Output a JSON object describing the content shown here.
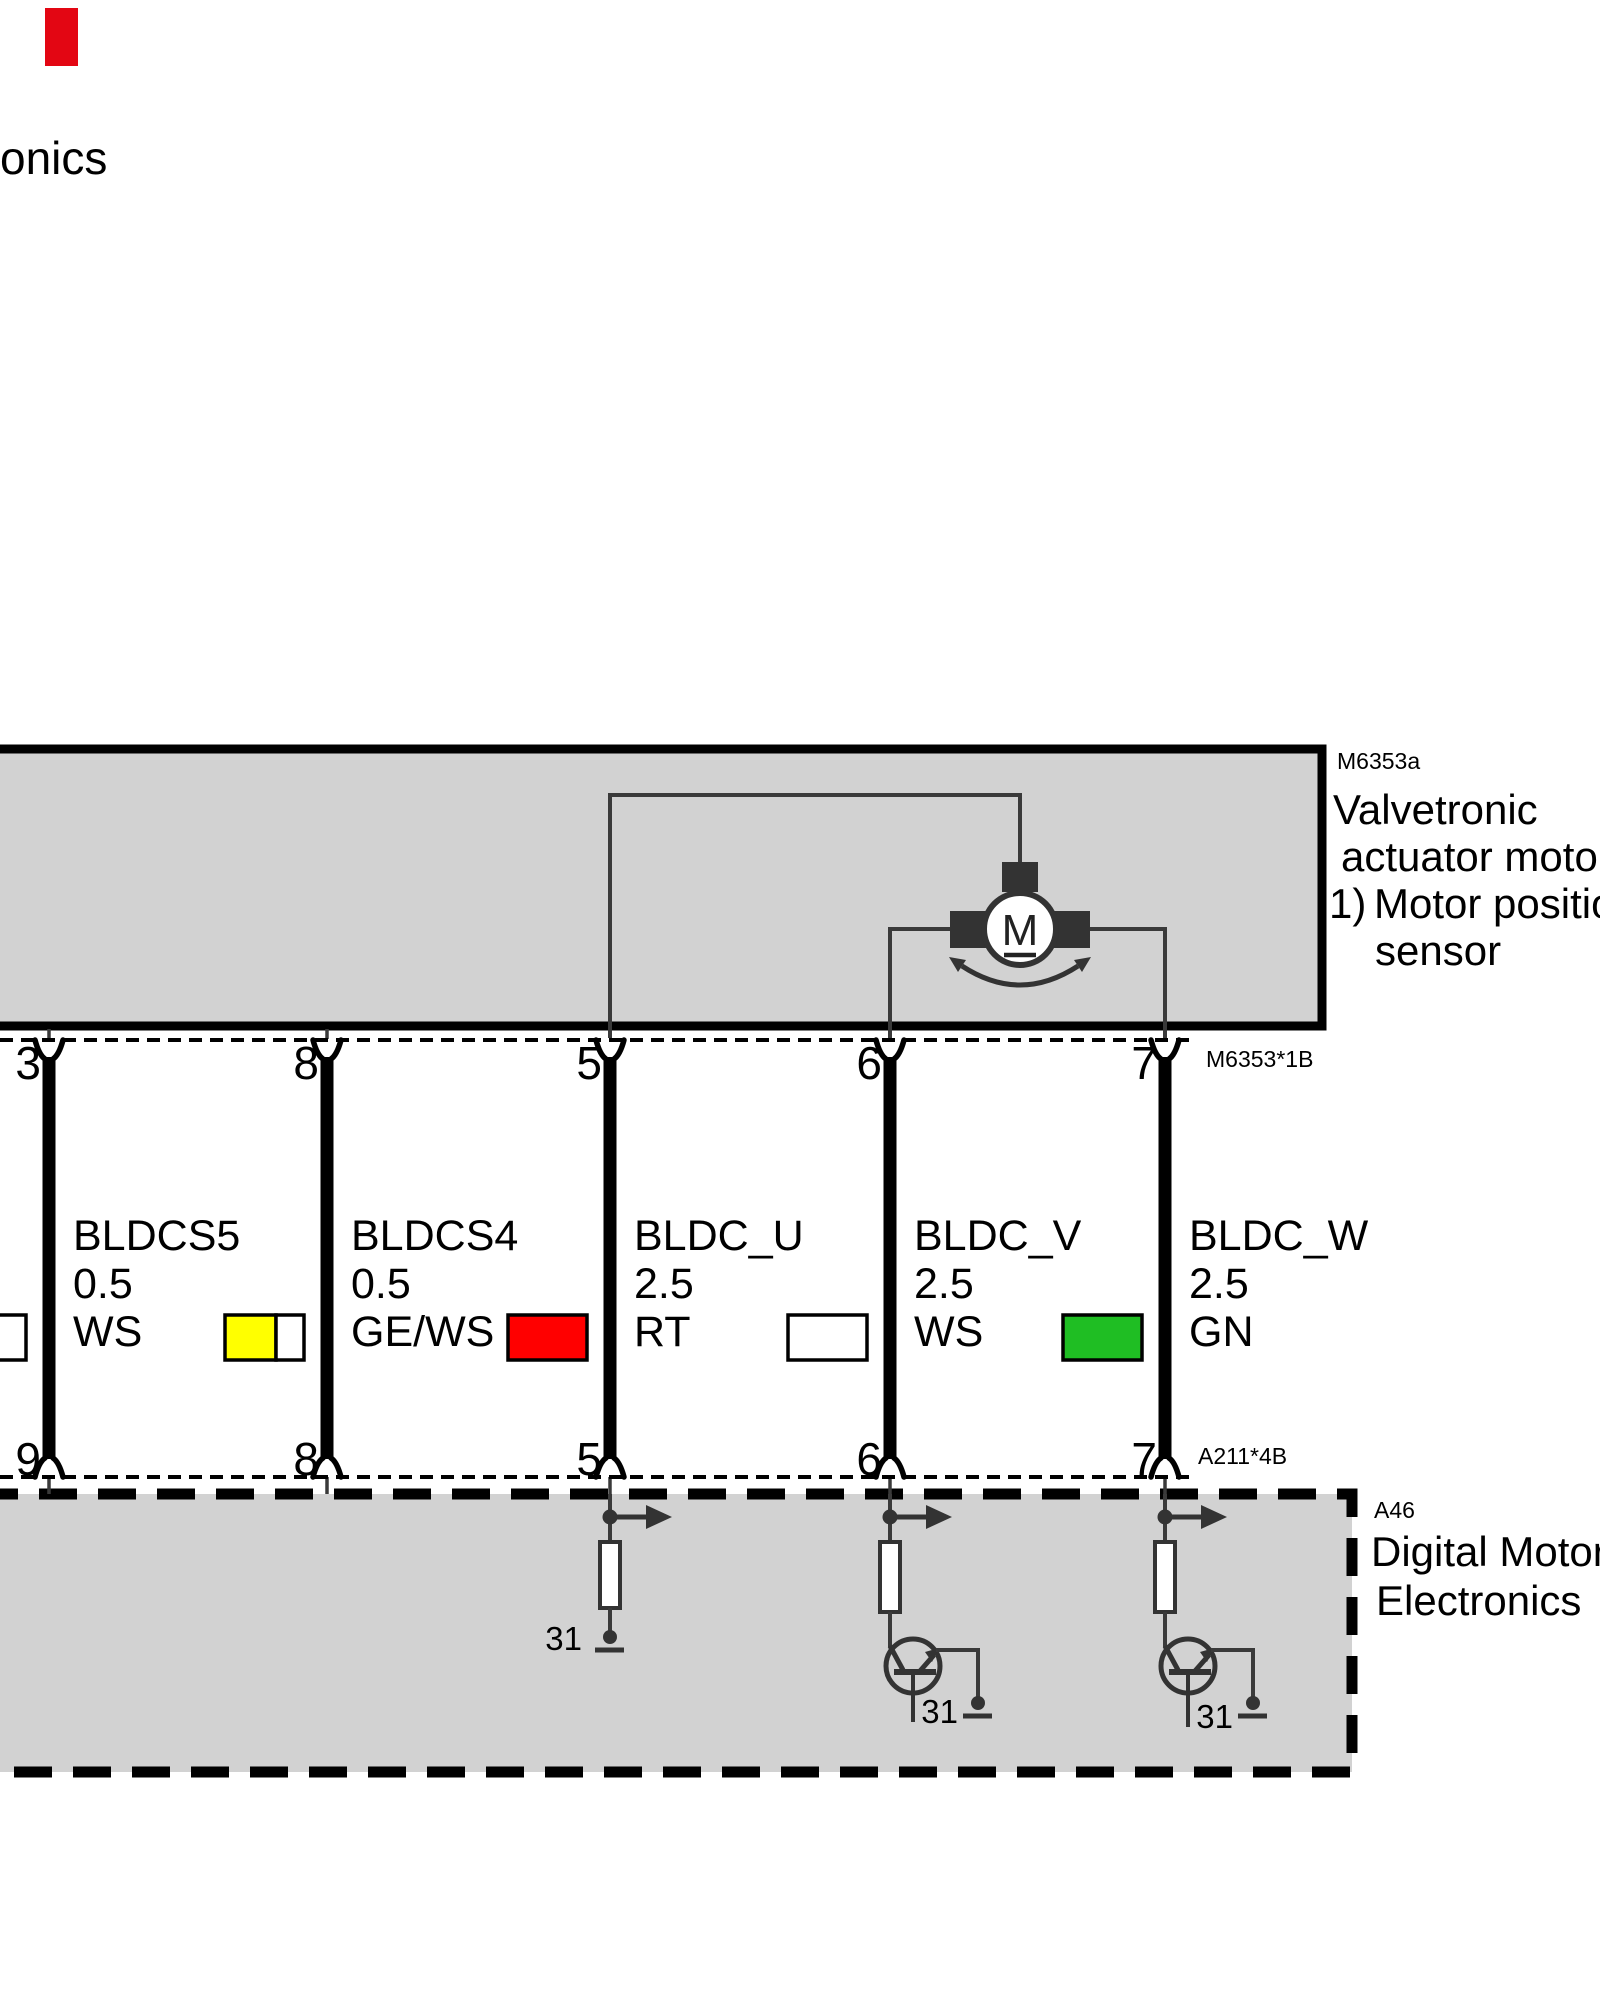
{
  "page": {
    "header_fragment": "onics",
    "marker_color": "#e30613"
  },
  "top_box": {
    "ref": "M6353a",
    "title_line1": "Valvetronic",
    "title_line2": "actuator motor",
    "note_number": "1)",
    "note_line1": "Motor position",
    "note_line2": "sensor",
    "fill": "#d2d2d2",
    "motor_letter": "M"
  },
  "connectors": {
    "top": {
      "ref": "M6353*1B",
      "pins": [
        "3",
        "8",
        "5",
        "6",
        "7"
      ]
    },
    "bottom": {
      "ref": "A211*4B",
      "pins": [
        "9",
        "8",
        "5",
        "6",
        "7"
      ]
    }
  },
  "wires": [
    {
      "name": "BLDCS5",
      "size": "0.5",
      "color_code": "WS",
      "swatch": [
        "#ffffff"
      ]
    },
    {
      "name": "BLDCS4",
      "size": "0.5",
      "color_code": "GE/WS",
      "swatch": [
        "#ffff00",
        "#ffffff"
      ]
    },
    {
      "name": "BLDC_U",
      "size": "2.5",
      "color_code": "RT",
      "swatch": [
        "#ff0000"
      ]
    },
    {
      "name": "BLDC_V",
      "size": "2.5",
      "color_code": "WS",
      "swatch": [
        "#ffffff"
      ]
    },
    {
      "name": "BLDC_W",
      "size": "2.5",
      "color_code": "GN",
      "swatch": [
        "#1fbe23"
      ]
    }
  ],
  "bottom_box": {
    "ref": "A46",
    "title_line1": "Digital Motor",
    "title_line2": "Electronics",
    "fill": "#d2d2d2",
    "ground_label": "31"
  }
}
